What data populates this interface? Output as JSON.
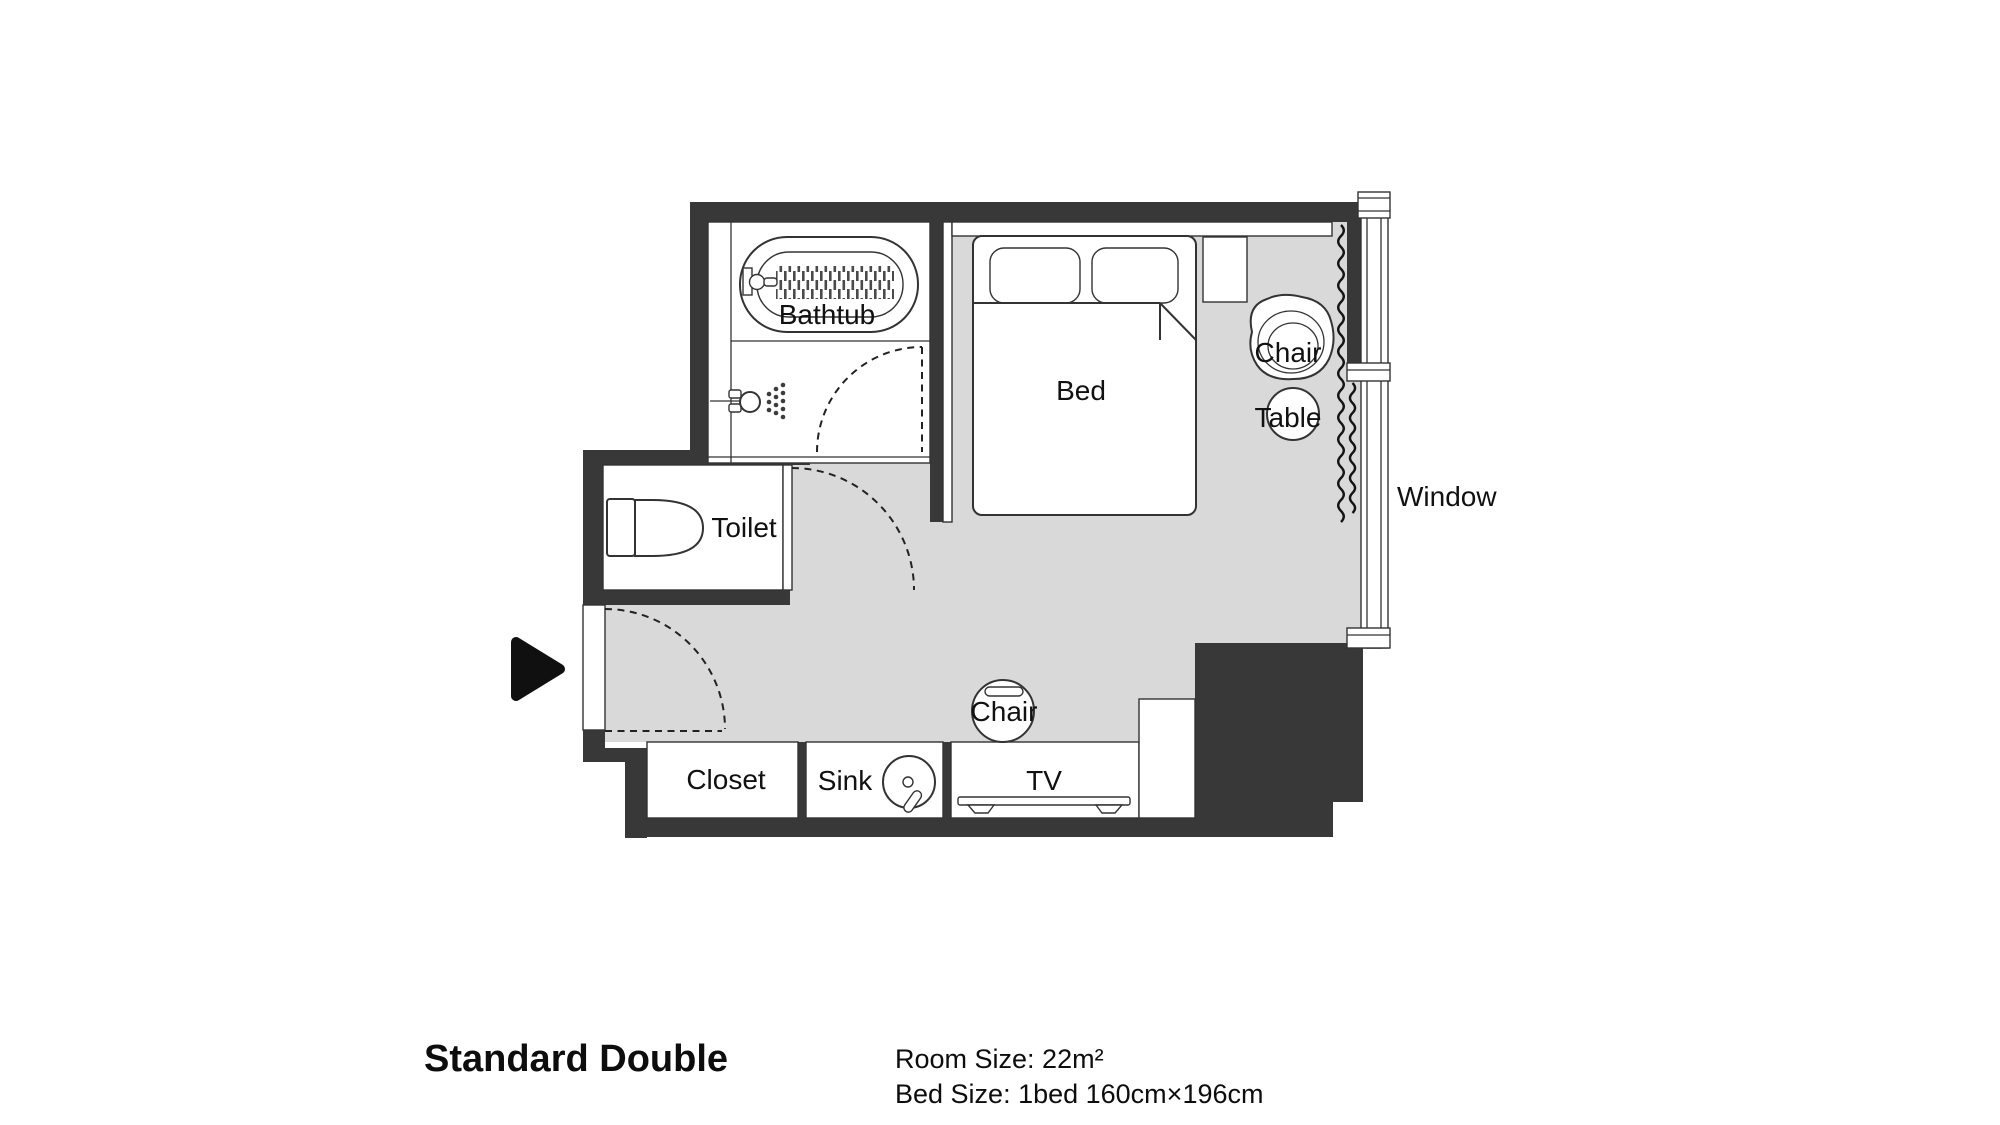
{
  "plan": {
    "labels": {
      "bathtub": "Bathtub",
      "toilet": "Toilet",
      "bed": "Bed",
      "chair_upper": "Chair",
      "table": "Table",
      "window": "Window",
      "chair_lower": "Chair",
      "closet": "Closet",
      "sink": "Sink",
      "tv": "TV"
    },
    "colors": {
      "wall": "#383838",
      "floor": "#d9d9d9",
      "line": "#333333",
      "ink": "#111111"
    },
    "icons": [
      "bathtub-icon",
      "tub-faucet-icon",
      "shower-icon",
      "toilet-icon",
      "bed-icon",
      "pillow-icon",
      "nightstand-icon",
      "armchair-icon",
      "table-icon",
      "curtain-icon",
      "window-icon",
      "door-swing-icon",
      "entrance-arrow-icon",
      "closet-icon",
      "sink-icon",
      "tv-icon",
      "chair-icon"
    ]
  },
  "caption": {
    "title": "Standard Double",
    "room_size": "Room Size: 22m²",
    "bed_size": "Bed Size: 1bed 160cm×196cm"
  }
}
